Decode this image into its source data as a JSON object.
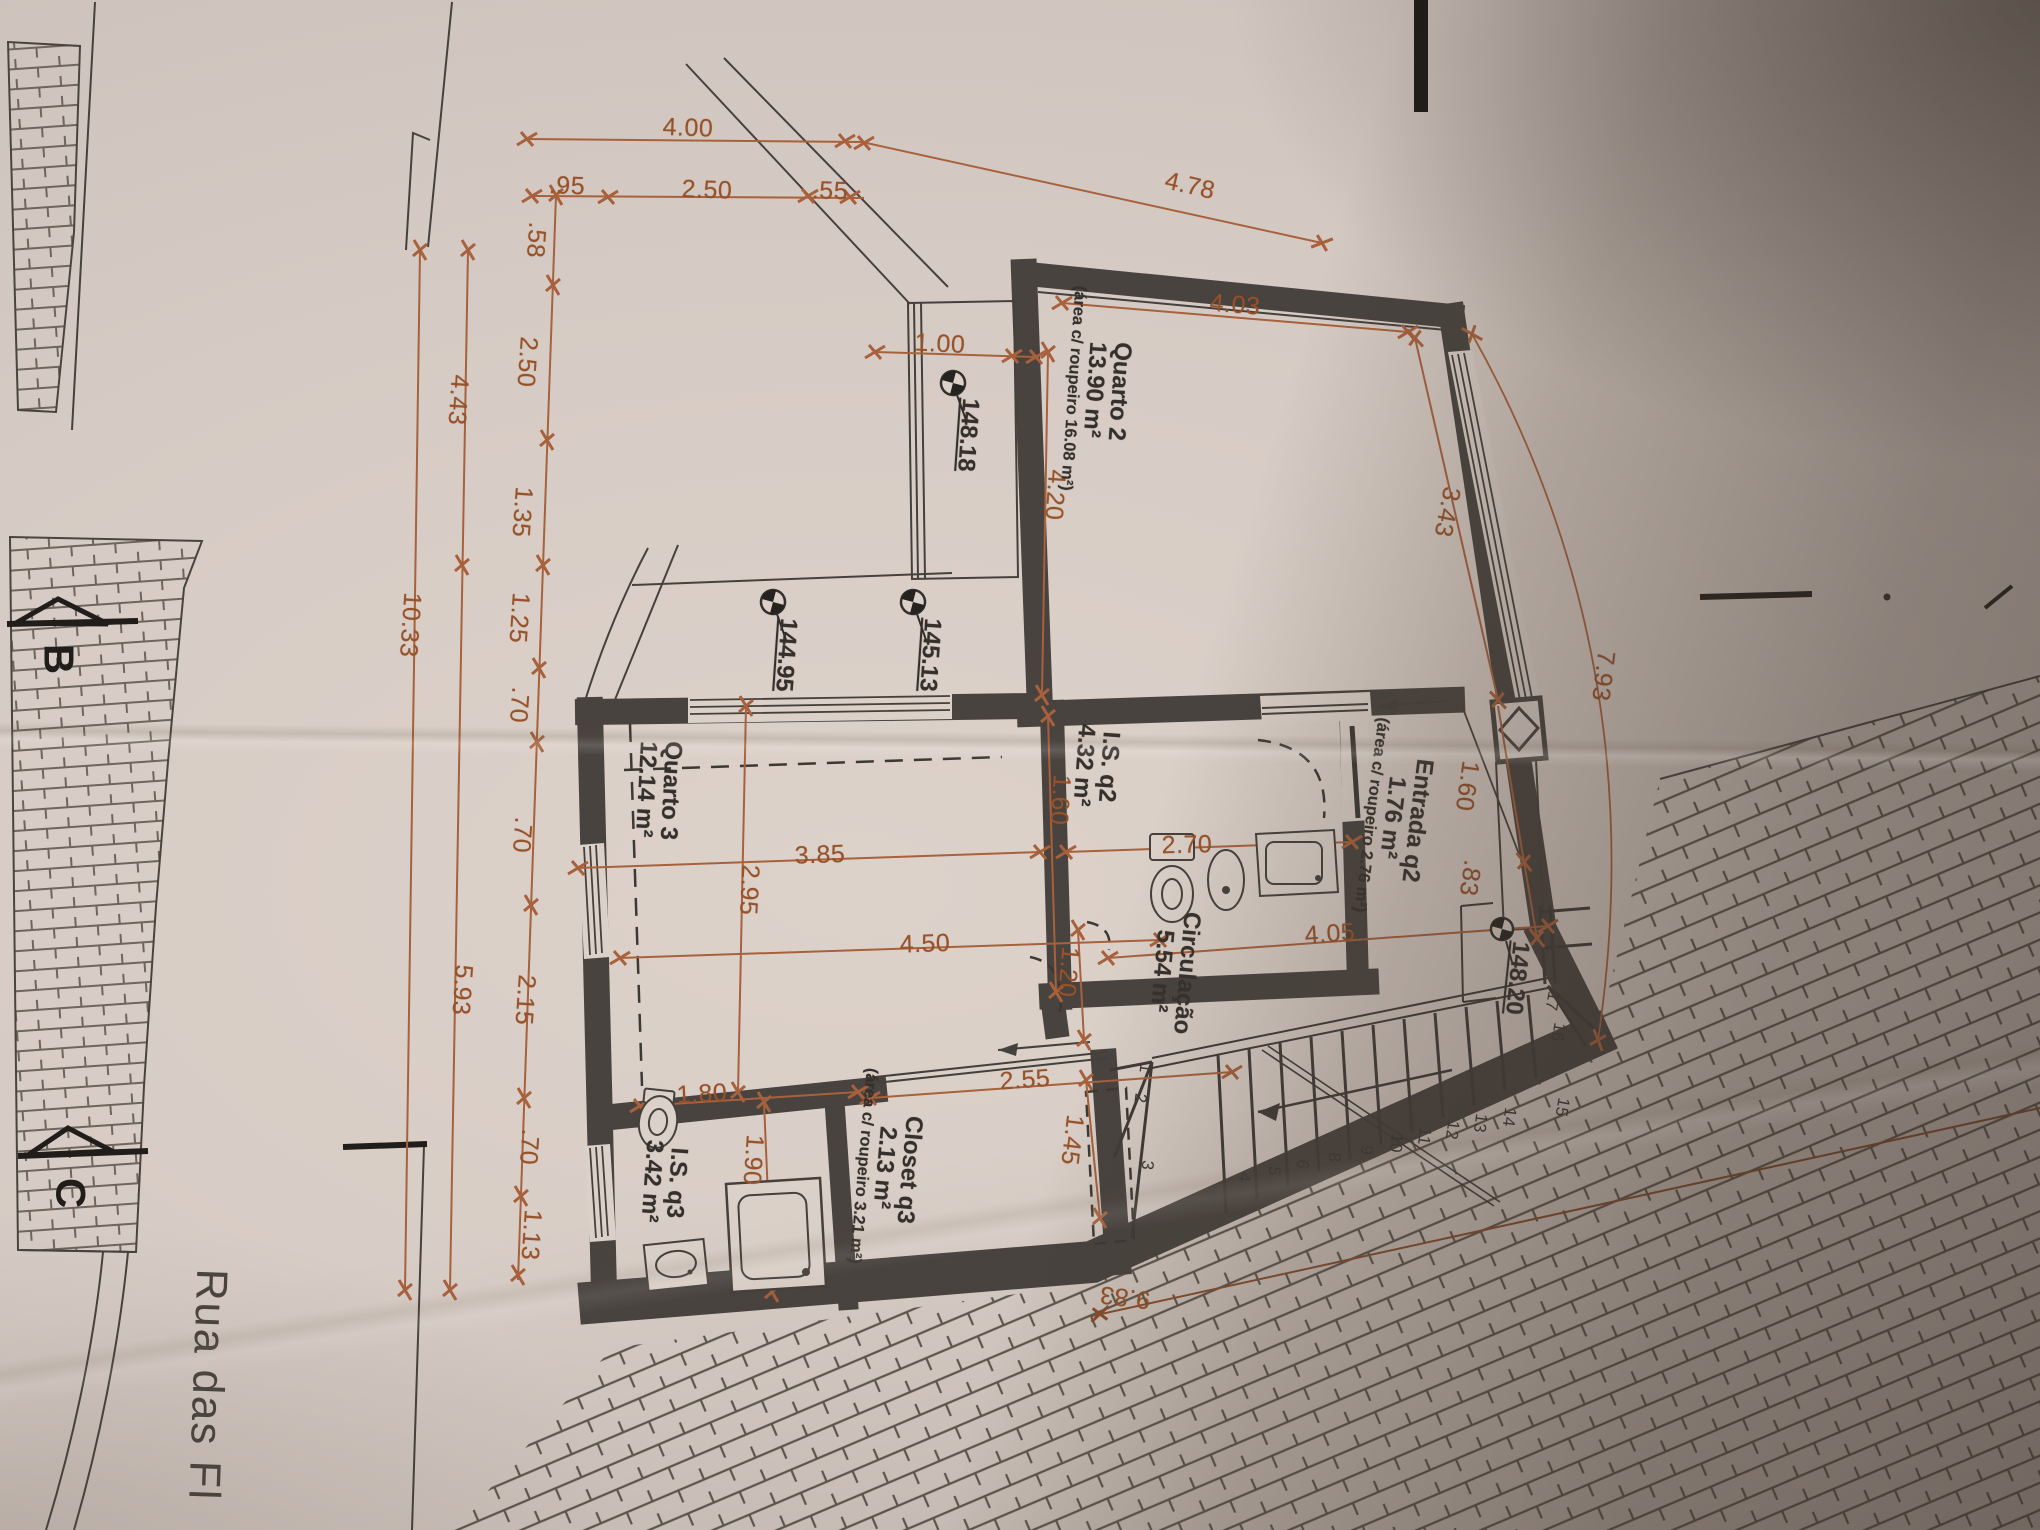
{
  "colors": {
    "paper": "#dbd1c9",
    "wall": "#48433f",
    "dim_accent": "#9a5127",
    "ink": "#35302c",
    "shadow": "#3a2f27"
  },
  "floor_plan": {
    "street": "Rua das Fl",
    "section_markers": [
      "B",
      "C"
    ],
    "elevation_points": [
      "148.18",
      "145.13",
      "144.95",
      "148.20"
    ],
    "rooms": [
      {
        "name": "Quarto 2",
        "area": "13.90 m²",
        "note": "(área c/ roupeiro 16.08 m²)"
      },
      {
        "name": "Entrada q2",
        "area": "1.76 m²",
        "note": "(área c/ roupeiro 2.76 m²)"
      },
      {
        "name": "I.S. q2",
        "area": "4.32 m²"
      },
      {
        "name": "Quarto 3",
        "area": "12.14 m²"
      },
      {
        "name": "Circulação",
        "area": "5.54 m²"
      },
      {
        "name": "Closet q3",
        "area": "2.13 m²",
        "note": "(área c/ roupeiro 3.21 m²)"
      },
      {
        "name": "I.S. q3",
        "area": "3.42 m²"
      }
    ],
    "stairs": {
      "visible_step_numbers": [
        "1",
        "2",
        "3",
        "4",
        "5",
        "6",
        "8",
        "9",
        "10",
        "11",
        "12",
        "13",
        "14",
        "15",
        "16",
        "17"
      ]
    },
    "dimensions_m": [
      "4.00",
      ".95",
      "2.50",
      ".55",
      "4.78",
      ".58",
      "2.50",
      "1.35",
      "1.25",
      ".70",
      ".70",
      "2.15",
      ".70",
      "1.13",
      "4.43",
      "5.93",
      "10.33",
      "1.00",
      "4.03",
      "4.20",
      "3.43",
      "1.60",
      ".83",
      "7.93",
      "1.60",
      "2.70",
      "3.85",
      "2.95",
      "4.50",
      "4.05",
      "1.20",
      "1.80",
      "2.55",
      "1.45",
      "1.90",
      "9.83"
    ]
  },
  "labels": [
    {
      "n": "dim-4-00",
      "t": "4.00",
      "x": 688,
      "y": 128,
      "r": 2,
      "c": "dim"
    },
    {
      "n": "dim-95",
      "t": ".95",
      "x": 567,
      "y": 186,
      "r": 2,
      "c": "dim"
    },
    {
      "n": "dim-2-50-top",
      "t": "2.50",
      "x": 707,
      "y": 190,
      "r": 2,
      "c": "dim"
    },
    {
      "n": "dim-55",
      "t": ".55",
      "x": 830,
      "y": 191,
      "r": 2,
      "c": "dim"
    },
    {
      "n": "dim-4-78",
      "t": "4.78",
      "x": 1190,
      "y": 186,
      "r": 13,
      "c": "dim"
    },
    {
      "n": "dim-58",
      "t": ".58",
      "x": 536,
      "y": 240,
      "r": 94,
      "c": "dim"
    },
    {
      "n": "dim-2-50-left",
      "t": "2.50",
      "x": 527,
      "y": 362,
      "r": 94,
      "c": "dim"
    },
    {
      "n": "dim-1-35",
      "t": "1.35",
      "x": 522,
      "y": 512,
      "r": 94,
      "c": "dim"
    },
    {
      "n": "dim-1-25",
      "t": "1.25",
      "x": 519,
      "y": 618,
      "r": 94,
      "c": "dim"
    },
    {
      "n": "dim-70-a",
      "t": ".70",
      "x": 519,
      "y": 705,
      "r": 94,
      "c": "dim"
    },
    {
      "n": "dim-70-b",
      "t": ".70",
      "x": 522,
      "y": 835,
      "r": 94,
      "c": "dim"
    },
    {
      "n": "dim-2-15",
      "t": "2.15",
      "x": 525,
      "y": 1000,
      "r": 94,
      "c": "dim"
    },
    {
      "n": "dim-70-c",
      "t": ".70",
      "x": 529,
      "y": 1147,
      "r": 94,
      "c": "dim"
    },
    {
      "n": "dim-1-13",
      "t": "1.13",
      "x": 531,
      "y": 1235,
      "r": 94,
      "c": "dim"
    },
    {
      "n": "dim-4-43",
      "t": "4.43",
      "x": 458,
      "y": 400,
      "r": 94,
      "c": "dim"
    },
    {
      "n": "dim-5-93",
      "t": "5.93",
      "x": 462,
      "y": 990,
      "r": 94,
      "c": "dim"
    },
    {
      "n": "dim-10-33",
      "t": "10.33",
      "x": 410,
      "y": 625,
      "r": 94,
      "c": "dim"
    },
    {
      "n": "dim-1-00",
      "t": "1.00",
      "x": 940,
      "y": 344,
      "r": 3,
      "c": "dim"
    },
    {
      "n": "dim-4-03",
      "t": "4.03",
      "x": 1235,
      "y": 305,
      "r": 5,
      "c": "dim"
    },
    {
      "n": "dim-4-20",
      "t": "4.20",
      "x": 1055,
      "y": 495,
      "r": 94,
      "c": "dim"
    },
    {
      "n": "dim-3-43",
      "t": "3.43",
      "x": 1447,
      "y": 512,
      "r": 101,
      "c": "dim"
    },
    {
      "n": "dim-1-60-right",
      "t": "1.60",
      "x": 1467,
      "y": 786,
      "r": 98,
      "c": "dim"
    },
    {
      "n": "dim-83",
      "t": ".83",
      "x": 1470,
      "y": 878,
      "r": 98,
      "c": "dim"
    },
    {
      "n": "dim-7-93",
      "t": "7.93",
      "x": 1603,
      "y": 676,
      "r": 97,
      "c": "dim"
    },
    {
      "n": "dim-1-60-isq2",
      "t": "1.60",
      "x": 1060,
      "y": 800,
      "r": 94,
      "c": "dim"
    },
    {
      "n": "dim-2-70",
      "t": "2.70",
      "x": 1187,
      "y": 845,
      "r": -1,
      "c": "dim"
    },
    {
      "n": "dim-3-85",
      "t": "3.85",
      "x": 820,
      "y": 855,
      "r": -2,
      "c": "dim"
    },
    {
      "n": "dim-2-95",
      "t": "2.95",
      "x": 749,
      "y": 890,
      "r": 93,
      "c": "dim"
    },
    {
      "n": "dim-4-50",
      "t": "4.50",
      "x": 925,
      "y": 944,
      "r": -2,
      "c": "dim"
    },
    {
      "n": "dim-4-05",
      "t": "4.05",
      "x": 1330,
      "y": 934,
      "r": -4,
      "c": "dim"
    },
    {
      "n": "dim-1-20",
      "t": "1.20",
      "x": 1068,
      "y": 972,
      "r": 95,
      "c": "dim"
    },
    {
      "n": "dim-1-80",
      "t": "1.80",
      "x": 702,
      "y": 1094,
      "r": -3,
      "c": "dim"
    },
    {
      "n": "dim-2-55",
      "t": "2.55",
      "x": 1025,
      "y": 1080,
      "r": -4,
      "c": "dim"
    },
    {
      "n": "dim-1-45",
      "t": "1.45",
      "x": 1072,
      "y": 1140,
      "r": 97,
      "c": "dim"
    },
    {
      "n": "dim-1-90",
      "t": "1.90",
      "x": 753,
      "y": 1160,
      "r": 94,
      "c": "dim"
    },
    {
      "n": "dim-9-83",
      "t": "9.83",
      "x": 1125,
      "y": 1297,
      "r": 187,
      "c": "dim"
    },
    {
      "n": "room-label-quarto2",
      "ls": [
        "Quarto 2",
        "13.90 m²"
      ],
      "sub": "(área c/ roupeiro 16.08 m²)",
      "x": 1098,
      "y": 390,
      "r": 94,
      "c": "room"
    },
    {
      "n": "room-label-entrada-q2",
      "ls": [
        "Entrada q2",
        "1.76 m²"
      ],
      "sub": "(área c/ roupeiro 2.76 m²)",
      "x": 1396,
      "y": 818,
      "r": 97,
      "c": "room"
    },
    {
      "n": "room-label-is-q2",
      "ls": [
        "I.S. q2",
        "4.32 m²"
      ],
      "x": 1096,
      "y": 766,
      "r": 94,
      "c": "room"
    },
    {
      "n": "room-label-quarto3",
      "ls": [
        "Quarto 3",
        "12.14 m²"
      ],
      "x": 658,
      "y": 790,
      "r": 93,
      "c": "room"
    },
    {
      "n": "room-label-circulacao",
      "ls": [
        "Circulação",
        "5.54 m²"
      ],
      "x": 1174,
      "y": 972,
      "r": 95,
      "c": "room"
    },
    {
      "n": "room-label-closet-q3",
      "ls": [
        "Closet q3",
        "2.13 m²"
      ],
      "sub": "(área c/ roupeiro 3.21 m²)",
      "x": 888,
      "y": 1168,
      "r": 95,
      "c": "room"
    },
    {
      "n": "room-label-is-q3",
      "ls": [
        "I.S. q3",
        "3.42 m²"
      ],
      "x": 664,
      "y": 1182,
      "r": 94,
      "c": "room"
    },
    {
      "n": "elevation-148-18",
      "t": "148.18",
      "x": 968,
      "y": 435,
      "r": 94,
      "c": "elev"
    },
    {
      "n": "elevation-145-13",
      "t": "145.13",
      "x": 930,
      "y": 655,
      "r": 94,
      "c": "elev"
    },
    {
      "n": "elevation-144-95",
      "t": "144.95",
      "x": 786,
      "y": 655,
      "r": 94,
      "c": "elev"
    },
    {
      "n": "elevation-148-20",
      "t": "148.20",
      "x": 1517,
      "y": 978,
      "r": 96,
      "c": "elev"
    },
    {
      "n": "stair-step-1",
      "t": "1",
      "x": 1145,
      "y": 1068,
      "r": 97,
      "c": "stno"
    },
    {
      "n": "stair-step-2",
      "t": "2",
      "x": 1140,
      "y": 1098,
      "r": 97,
      "c": "stno"
    },
    {
      "n": "stair-step-3",
      "t": "3",
      "x": 1147,
      "y": 1165,
      "r": 97,
      "c": "stno"
    },
    {
      "n": "stair-step-4",
      "t": "4",
      "x": 1244,
      "y": 1177,
      "r": 97,
      "c": "stno"
    },
    {
      "n": "stair-step-5",
      "t": "5",
      "x": 1274,
      "y": 1171,
      "r": 97,
      "c": "stno"
    },
    {
      "n": "stair-step-6",
      "t": "6",
      "x": 1302,
      "y": 1164,
      "r": 97,
      "c": "stno"
    },
    {
      "n": "stair-step-8",
      "t": "8",
      "x": 1334,
      "y": 1157,
      "r": 97,
      "c": "stno"
    },
    {
      "n": "stair-step-9",
      "t": "9",
      "x": 1366,
      "y": 1150,
      "r": 97,
      "c": "stno"
    },
    {
      "n": "stair-step-10",
      "t": "10",
      "x": 1396,
      "y": 1143,
      "r": 97,
      "c": "stno"
    },
    {
      "n": "stair-step-11",
      "t": "11",
      "x": 1424,
      "y": 1136,
      "r": 97,
      "c": "stno"
    },
    {
      "n": "stair-step-12",
      "t": "12",
      "x": 1452,
      "y": 1130,
      "r": 97,
      "c": "stno"
    },
    {
      "n": "stair-step-13",
      "t": "13",
      "x": 1480,
      "y": 1123,
      "r": 97,
      "c": "stno"
    },
    {
      "n": "stair-step-14",
      "t": "14",
      "x": 1509,
      "y": 1117,
      "r": 97,
      "c": "stno"
    },
    {
      "n": "stair-step-15",
      "t": "15",
      "x": 1562,
      "y": 1107,
      "r": 100,
      "c": "stno"
    },
    {
      "n": "stair-step-16",
      "t": "16",
      "x": 1558,
      "y": 1032,
      "r": 100,
      "c": "stno"
    },
    {
      "n": "stair-step-17",
      "t": "17",
      "x": 1552,
      "y": 1001,
      "r": 100,
      "c": "stno"
    },
    {
      "n": "section-letter-b",
      "t": "B",
      "x": 58,
      "y": 659,
      "r": 90,
      "c": "sec"
    },
    {
      "n": "section-letter-c",
      "t": "C",
      "x": 70,
      "y": 1193,
      "r": 90,
      "c": "sec"
    },
    {
      "n": "street-name",
      "t": "Rua das Fl",
      "x": 207,
      "y": 1385,
      "r": 92,
      "c": "street"
    }
  ]
}
